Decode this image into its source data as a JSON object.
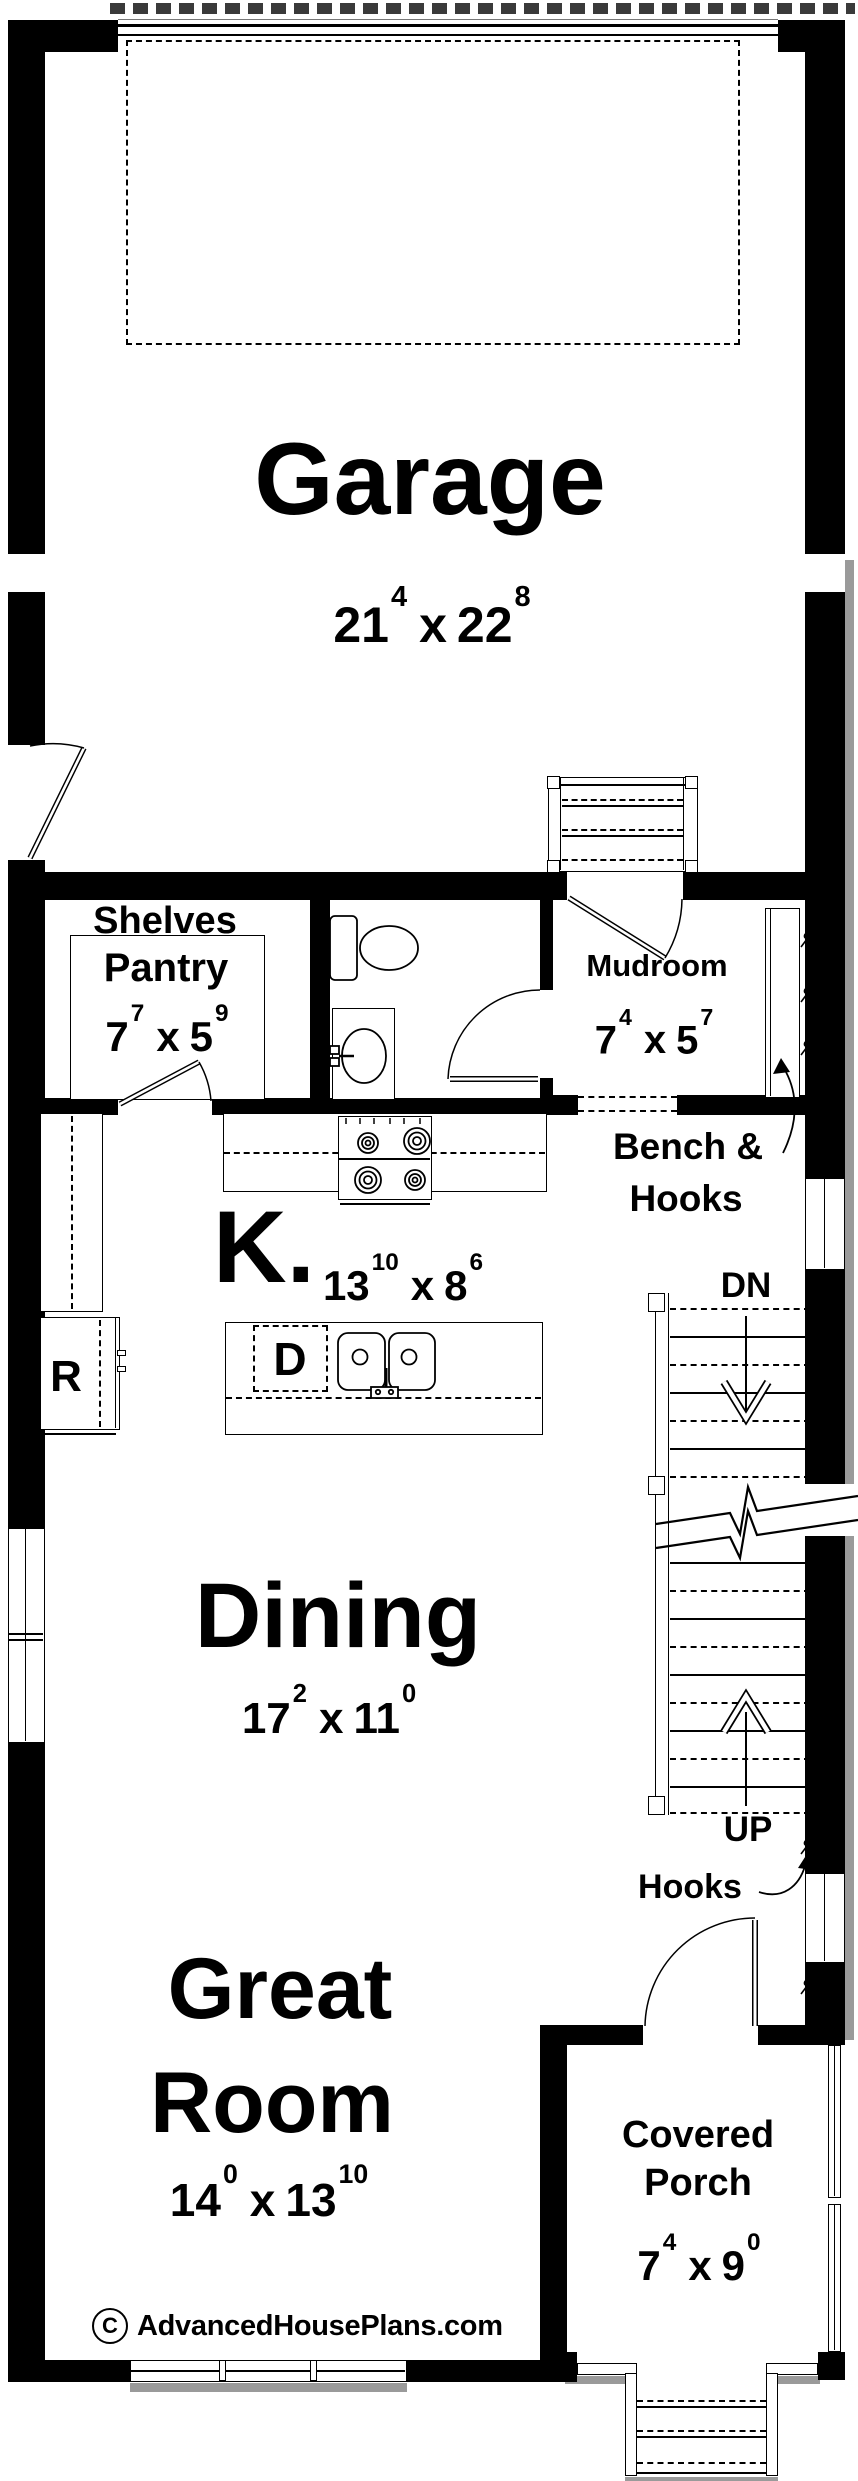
{
  "plan": {
    "dim_separator": "x",
    "brand": {
      "copyright": "C",
      "site": "AdvancedHousePlans.com"
    },
    "rooms": {
      "garage": {
        "name": "Garage",
        "wft": "21",
        "win": "4",
        "hft": "22",
        "hin": "8"
      },
      "pantry": {
        "shelves": "Shelves",
        "name": "Pantry",
        "wft": "7",
        "win": "7",
        "hft": "5",
        "hin": "9"
      },
      "mudroom": {
        "name": "Mudroom",
        "wft": "7",
        "win": "4",
        "hft": "5",
        "hin": "7"
      },
      "kitchen": {
        "name": "K.",
        "wft": "13",
        "win": "10",
        "hft": "8",
        "hin": "6"
      },
      "dining": {
        "name": "Dining",
        "wft": "17",
        "win": "2",
        "hft": "11",
        "hin": "0"
      },
      "great_room": {
        "name1": "Great",
        "name2": "Room",
        "wft": "14",
        "win": "0",
        "hft": "13",
        "hin": "10"
      },
      "covered_porch": {
        "name1": "Covered",
        "name2": "Porch",
        "wft": "7",
        "win": "4",
        "hft": "9",
        "hin": "0"
      }
    },
    "labels": {
      "bench1": "Bench &",
      "bench2": "Hooks",
      "hooks": "Hooks",
      "dn": "DN",
      "up": "UP",
      "refrigerator": "R",
      "dishwasher": "D"
    },
    "colors": {
      "wall": "#000000",
      "bg": "#ffffff",
      "shadow": "#9a9a9a"
    }
  }
}
